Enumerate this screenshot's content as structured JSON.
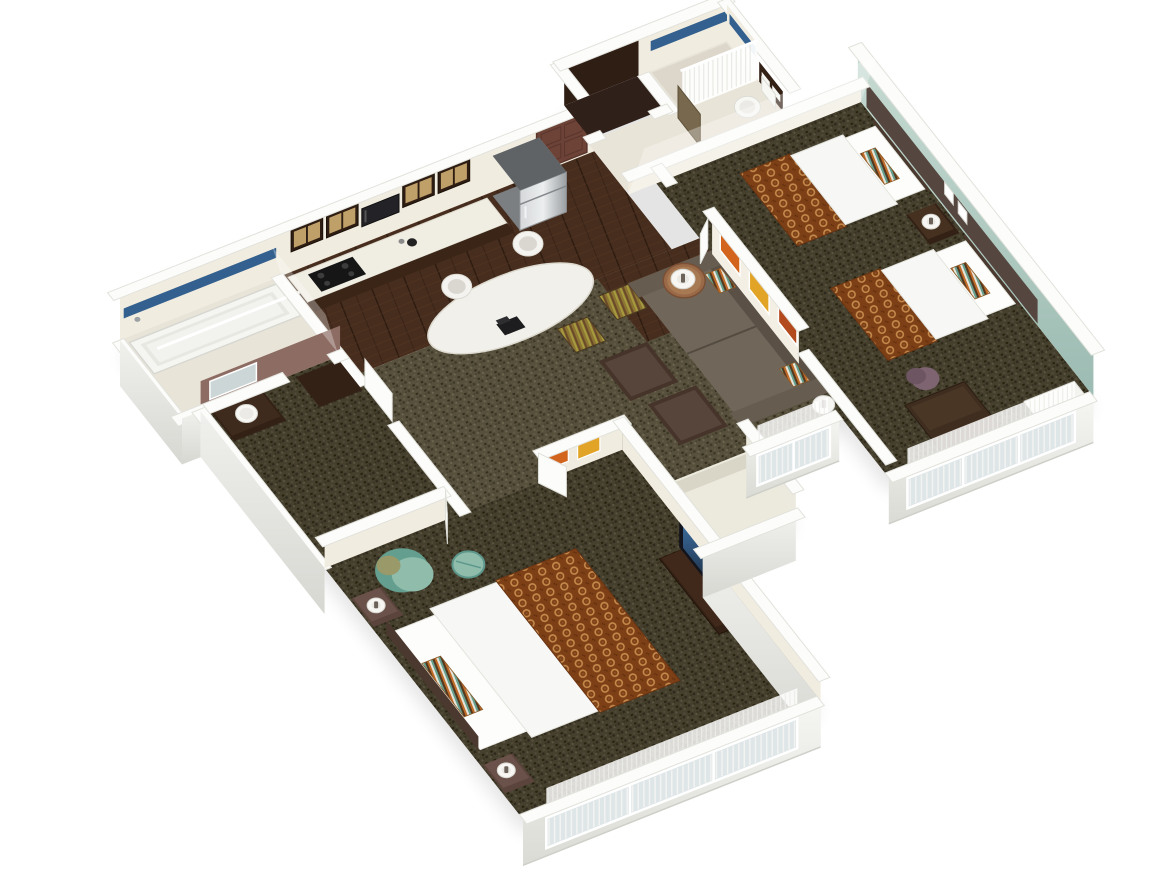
{
  "title": "3D isometric floor plan — two-bedroom hotel suite",
  "view": {
    "type": "isometric-3d-floor-plan",
    "background": "#ffffff"
  },
  "rooms": [
    {
      "id": "kitchen",
      "label": "Kitchen"
    },
    {
      "id": "dining-area",
      "label": "Dining area"
    },
    {
      "id": "entry-hall",
      "label": "Entry hall"
    },
    {
      "id": "entry-closet",
      "label": "Entry closet"
    },
    {
      "id": "bathroom-1",
      "label": "Bathroom with shower"
    },
    {
      "id": "bathroom-2",
      "label": "Bathroom with tub"
    },
    {
      "id": "vanity-corridor",
      "label": "Vanity corridor"
    },
    {
      "id": "living-room",
      "label": "Living room"
    },
    {
      "id": "bedroom-1",
      "label": "Bedroom with two queen beds"
    },
    {
      "id": "bedroom-2",
      "label": "Bedroom with king bed"
    },
    {
      "id": "closet-nook",
      "label": "Closet nook"
    }
  ],
  "furniture": [
    "entry-door",
    "refrigerator",
    "kitchen-counter",
    "cooktop",
    "coffee-maker",
    "upper-cabinets",
    "microwave",
    "dining-table",
    "dining-chairs",
    "telephone",
    "sleeper-sofa",
    "throw-pillows",
    "ottomans",
    "side-table",
    "table-lamp",
    "floor-lamp",
    "wall-art",
    "queen-bed-1",
    "queen-bed-2",
    "nightstand",
    "wall-sconces",
    "desk",
    "desk-chair",
    "king-bed",
    "teal-armchair",
    "teal-ottoman",
    "tv-dresser",
    "television",
    "bathtub",
    "shower",
    "shower-curtain",
    "toilet",
    "bathroom-vanity",
    "vanity-sink",
    "vanity-mirror",
    "accent-wall",
    "windows",
    "sheer-curtains"
  ],
  "palette": {
    "background": "#ffffff",
    "shadow": "#bdbdba",
    "wall_top": "#fcfcfb",
    "wall_edge": "#e2e2dc",
    "wall_face": "#f3f2ee",
    "wall_face_shade": "#dddcd6",
    "interior_face": "#f1ece0",
    "carpet_living": "#57503d",
    "carpet_bedroom": "#453f2e",
    "wood_floor": "#472d1d",
    "tile_floor": "#e9e4d8",
    "tile_shower": "#dcd7ca",
    "bedding": "#f7f7f5",
    "bed_runner": "#7c3f16",
    "runner_ring": "#c58a4c",
    "headboard_panel": "#55463f",
    "headboard": "#4b382e",
    "accent_sage": "#b2ccc3",
    "accent_sage_deep": "#93b2a9",
    "dark_wood": "#342116",
    "cabinet_pane": "#c0a069",
    "stainless": "#c6c9cc",
    "stainless_deep": "#989ca0",
    "sofa": "#71665a",
    "sofa_dark": "#5a5046",
    "ottoman": "#46342a",
    "ottoman_top": "#57443a",
    "teal": "#8fbcab",
    "teal_deep": "#639e8e",
    "cushion_olive": "#99996a",
    "mauve_wall": "#8d6c63",
    "chair_mauve": "#7d6470",
    "blue_tile": "#33608e",
    "door_brown": "#6e4337",
    "door_olive": "#77684e",
    "art_orange": "#d2641d",
    "art_amber": "#e2a426",
    "art_rust": "#b34a1e",
    "window_glass": "#dfe6e8",
    "curtain_white": "#ffffff",
    "tv_body": "#14141c",
    "tv_screen": "#2c4d72",
    "side_table_wood": "#9a6a48",
    "phone_black": "#1d1d1f",
    "lamp_white": "#f7f6f2"
  }
}
